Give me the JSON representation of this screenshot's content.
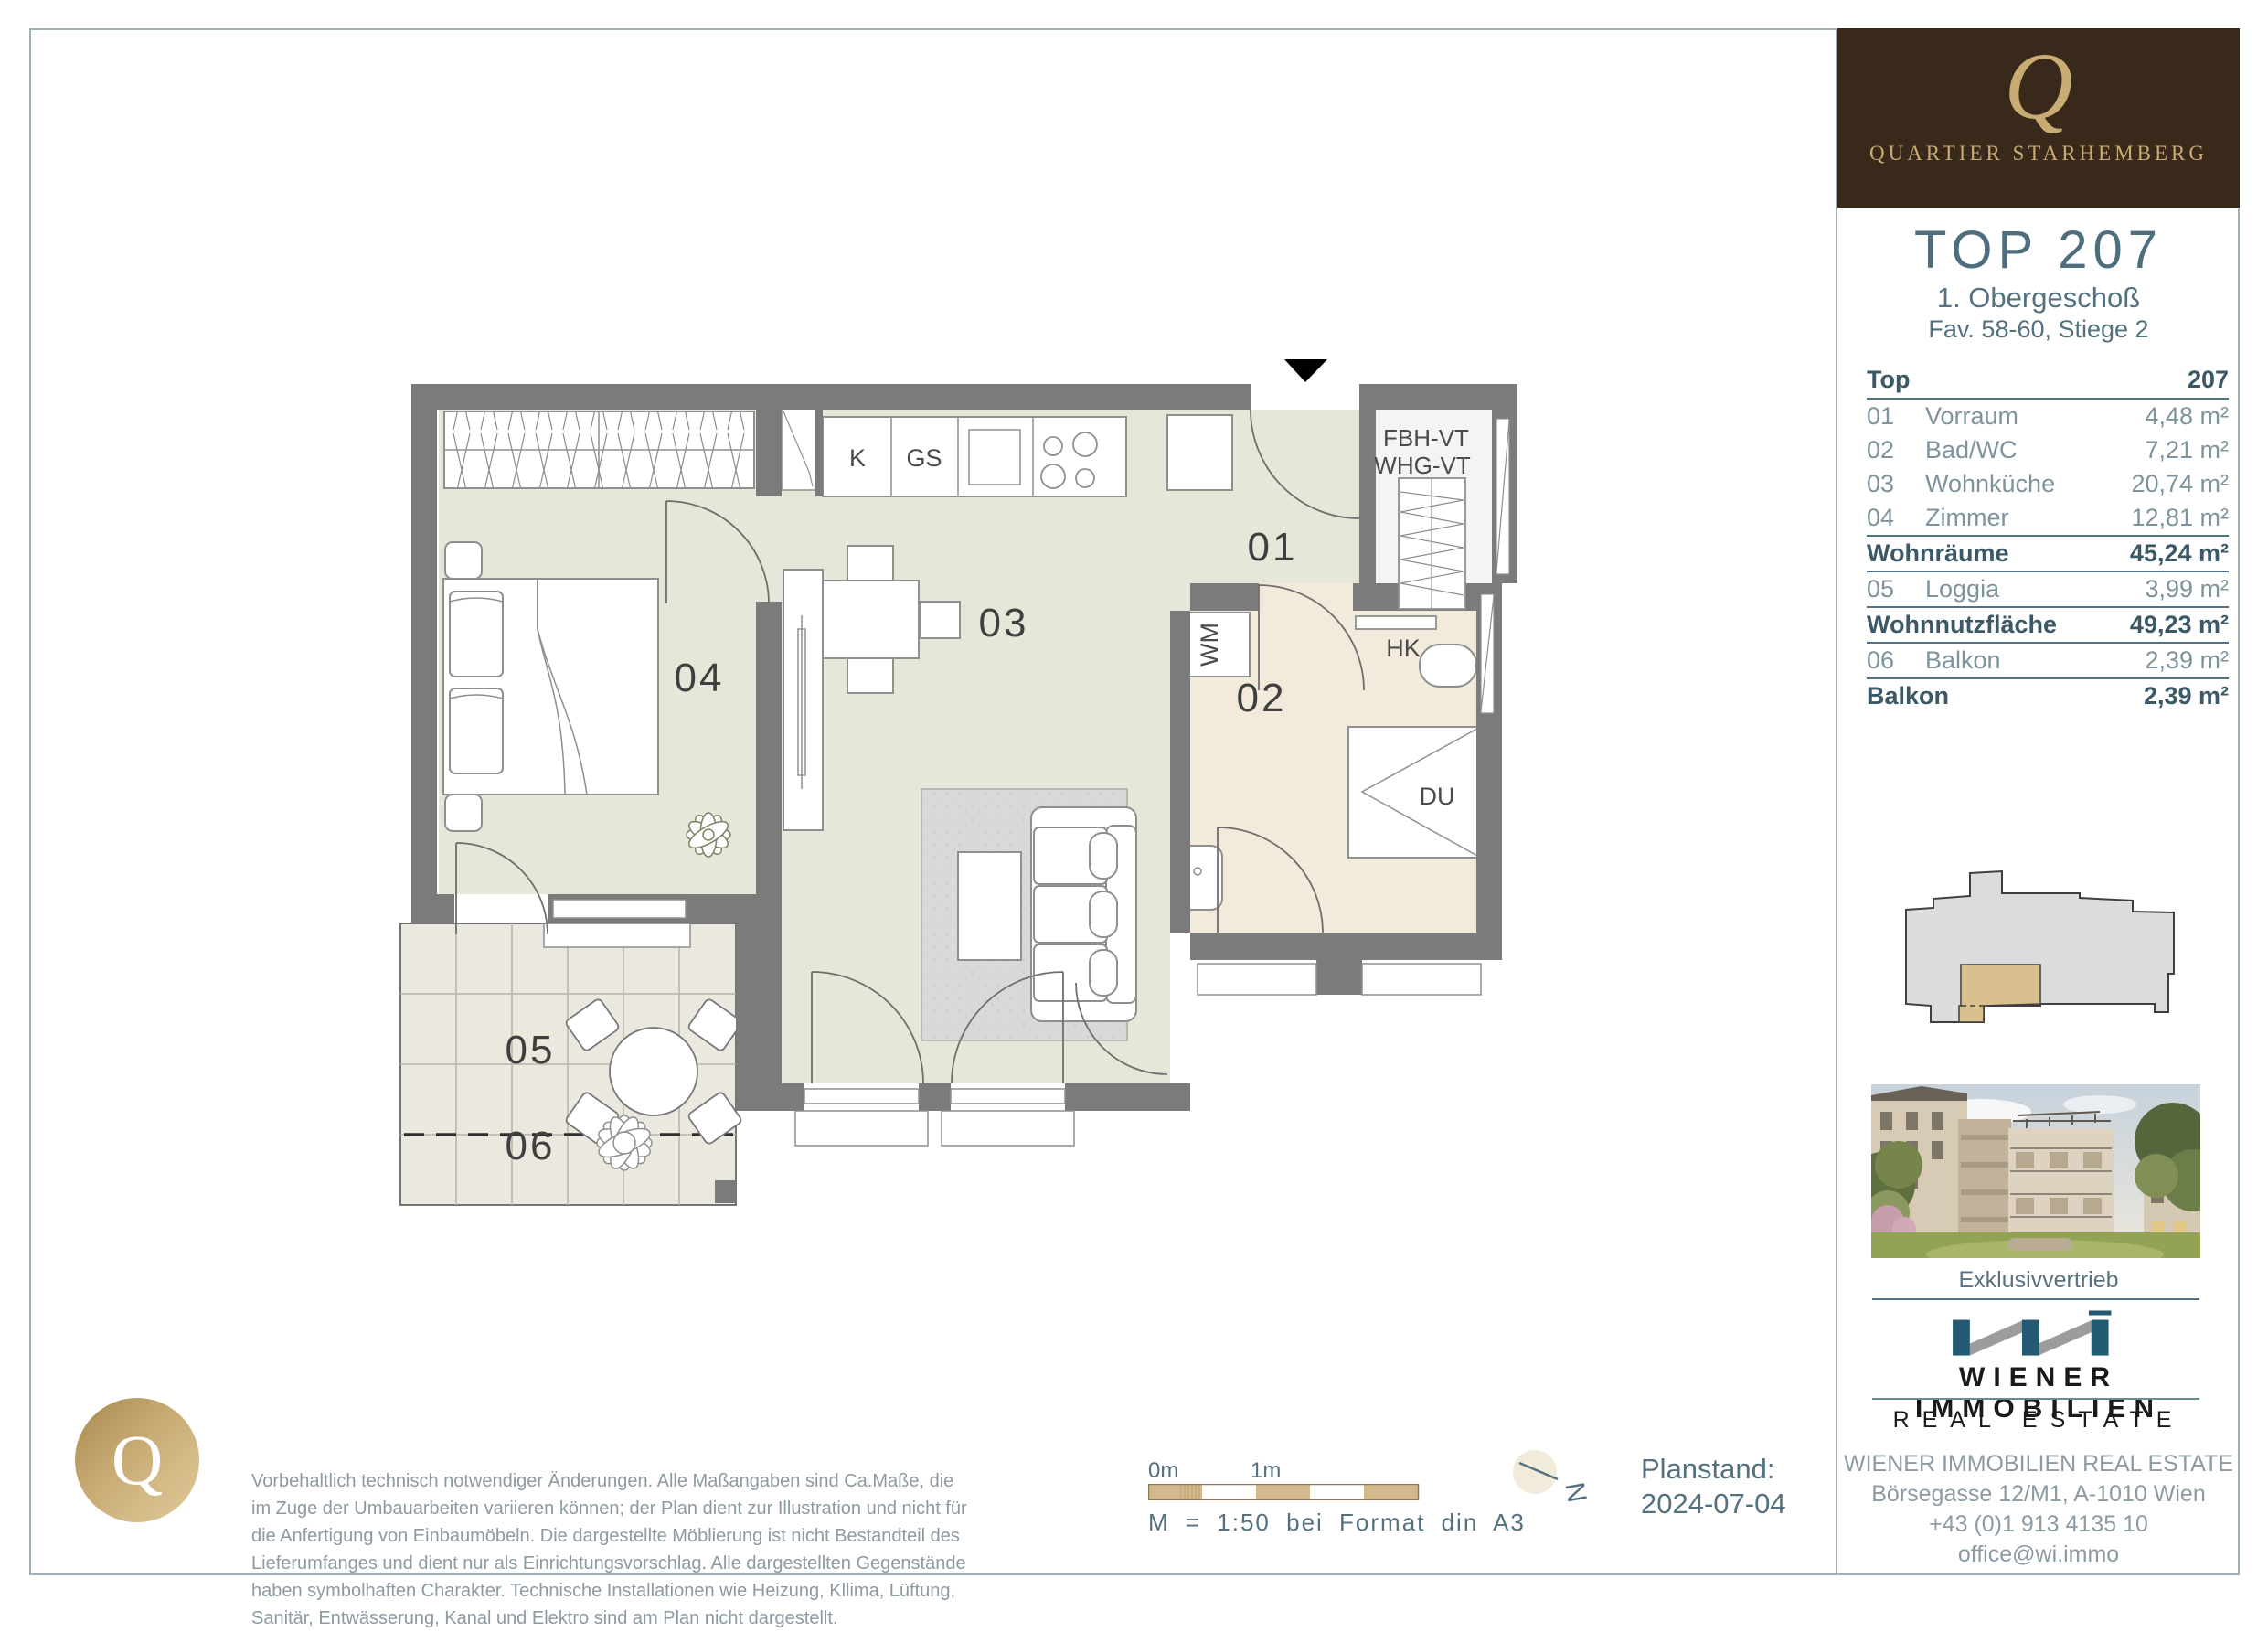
{
  "brand": {
    "q_glyph": "Q",
    "wordmark": "QUARTIER STARHEMBERG"
  },
  "unit": {
    "title": "TOP 207",
    "floor": "1. Obergeschoß",
    "subtitle": "Fav. 58-60, Stiege 2"
  },
  "table": {
    "header": {
      "label": "Top",
      "value": "207"
    },
    "rows": [
      {
        "num": "01",
        "name": "Vorraum",
        "value": "4,48 m²"
      },
      {
        "num": "02",
        "name": "Bad/WC",
        "value": "7,21 m²"
      },
      {
        "num": "03",
        "name": "Wohnküche",
        "value": "20,74 m²"
      },
      {
        "num": "04",
        "name": "Zimmer",
        "value": "12,81 m²"
      },
      {
        "label": "Wohnräume",
        "value": "45,24 m²",
        "bold": true
      },
      {
        "num": "05",
        "name": "Loggia",
        "value": "3,99 m²"
      },
      {
        "label": "Wohnnutzfläche",
        "value": "49,23 m²",
        "bold": true
      },
      {
        "num": "06",
        "name": "Balkon",
        "value": "2,39 m²"
      },
      {
        "label": "Balkon",
        "value": "2,39 m²",
        "bold": true,
        "last": true
      }
    ]
  },
  "plan": {
    "rooms": {
      "r01": "01",
      "r02": "02",
      "r03": "03",
      "r04": "04",
      "r05": "05",
      "r06": "06"
    },
    "labels": {
      "kitchen_k": "K",
      "kitchen_gs": "GS",
      "washing_machine": "WM",
      "shower": "DU",
      "radiator": "HK",
      "shaft_line1": "FBH-VT",
      "shaft_line2": "WHG-VT"
    }
  },
  "distribution": {
    "heading": "Exklusivvertrieb",
    "logo_name": "WIENER IMMOBILIEN",
    "logo_sub": "REAL ESTATE",
    "company": "WIENER IMMOBILIEN REAL ESTATE",
    "address": "Börsegasse 12/M1, A-1010 Wien",
    "phone": "+43 (0)1 913 4135 10",
    "email": "office@wi.immo"
  },
  "footer": {
    "disclaimer": "Vorbehaltlich technisch notwendiger Änderungen. Alle Maßangaben sind Ca.Maße, die im Zuge der Umbauarbeiten variieren können; der Plan dient zur Illustration und nicht für die Anfertigung von Einbaumöbeln. Die dargestellte Möblierung ist nicht Bestandteil des Lieferumfanges und dient nur als Einrichtungsvorschlag. Alle dargestellten Gegenstände haben symbolhaften Charakter. Technische Installationen wie Heizung, Kllima, Lüftung, Sanitär, Entwässerung, Kanal und Elektro sind am Plan nicht dargestellt.",
    "scale_zero": "0m",
    "scale_one": "1m",
    "scale_text": "M = 1:50 bei Format din A3",
    "north_letter": "N",
    "planstand_label": "Planstand:",
    "planstand_date": "2024-07-04"
  },
  "colors": {
    "accent": "#54717f",
    "gold": "#c9ab74",
    "brown": "#38291b",
    "navy": "#235a73",
    "wall_gray": "#7b7b7b",
    "floor_sage": "#e6e7d9",
    "floor_beige": "#f2ebdb",
    "tile": "#eae8df",
    "scale_tan": "#d3ba8c"
  }
}
